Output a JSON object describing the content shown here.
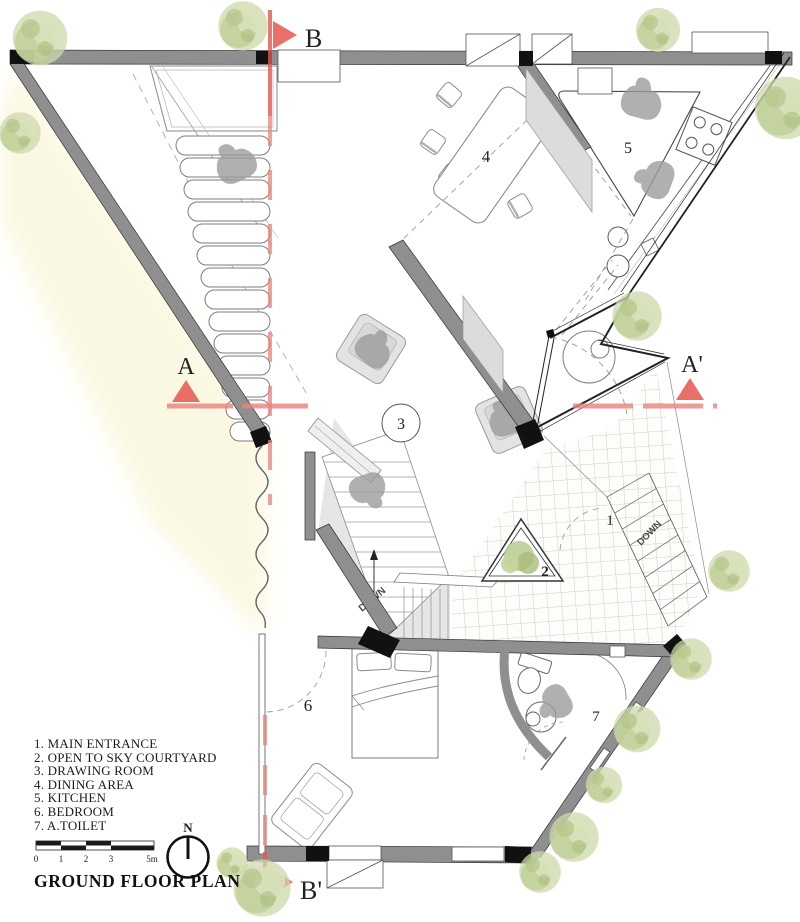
{
  "title": "GROUND FLOOR PLAN",
  "rooms": [
    {
      "number": "1",
      "name": "MAIN ENTRANCE",
      "legend_label": "1. MAIN ENTRANCE"
    },
    {
      "number": "2",
      "name": "OPEN TO SKY COURTYARD",
      "legend_label": "2. OPEN TO SKY COURTYARD"
    },
    {
      "number": "3",
      "name": "DRAWING ROOM",
      "legend_label": "3. DRAWING ROOM"
    },
    {
      "number": "4",
      "name": "DINING AREA",
      "legend_label": "4. DINING AREA"
    },
    {
      "number": "5",
      "name": "KITCHEN",
      "legend_label": "5. KITCHEN"
    },
    {
      "number": "6",
      "name": "BEDROOM",
      "legend_label": "6. BEDROOM"
    },
    {
      "number": "7",
      "name": "A.TOILET",
      "legend_label": "7. A.TOILET"
    }
  ],
  "sections": {
    "b": "B",
    "b_prime": "B'",
    "a": "A",
    "a_prime": "A'"
  },
  "labels": {
    "down": "DOWN",
    "north": "N"
  },
  "scale": {
    "ticks": [
      "0",
      "1",
      "2",
      "3",
      "5m"
    ]
  },
  "colors": {
    "section_red": "#e4574e",
    "section_red_light": "#e8837c",
    "wall_gray": "#8f8f8f",
    "wall_slab": "#dcdcdc",
    "tree_green": "#c6d3a0",
    "tile_line": "#c9d1c2",
    "stair_fill": "#e6e6e6",
    "figure_gray": "#9c9c9c",
    "glow_yellow": "#f7f2c8"
  }
}
